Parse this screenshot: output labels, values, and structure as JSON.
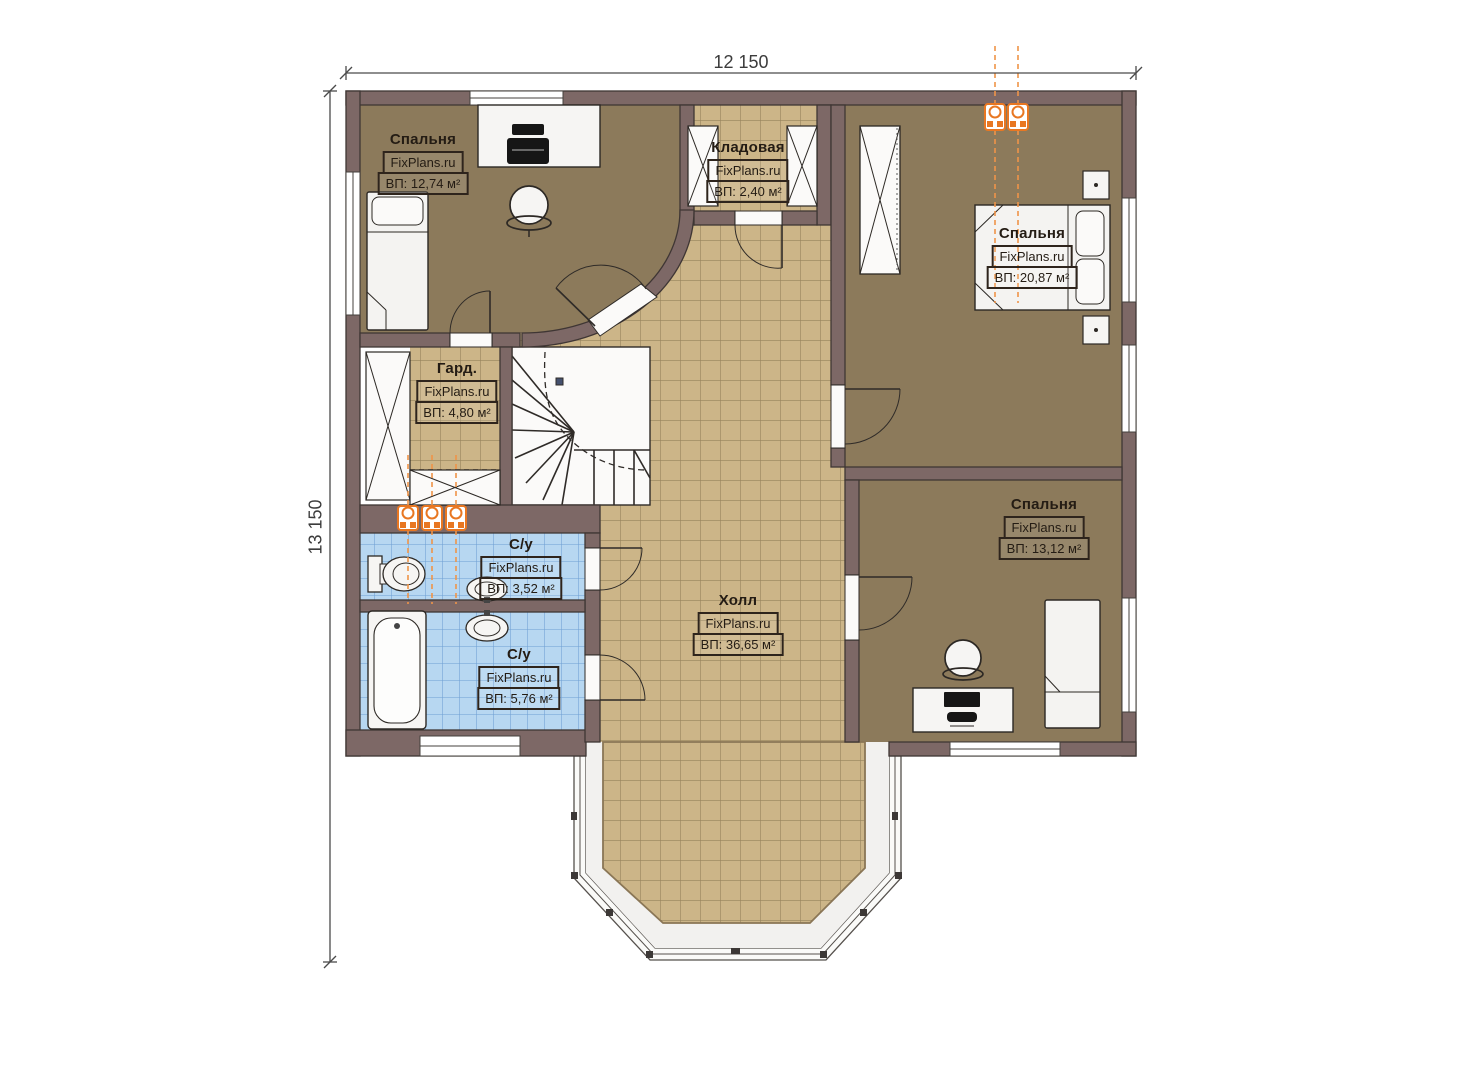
{
  "plan": {
    "type": "floor-plan",
    "watermark": "FixPlans.ru"
  },
  "dimensions": {
    "width_label": "12 150",
    "height_label": "13 150"
  },
  "rooms": [
    {
      "id": "bedroom-top-left",
      "name": "Спальня",
      "site": "FixPlans.ru",
      "area": "ВП: 12,74 м²"
    },
    {
      "id": "storage",
      "name": "Кладовая",
      "site": "FixPlans.ru",
      "area": "ВП: 2,40 м²"
    },
    {
      "id": "bedroom-top-right",
      "name": "Спальня",
      "site": "FixPlans.ru",
      "area": "ВП: 20,87 м²"
    },
    {
      "id": "wardrobe",
      "name": "Гард.",
      "site": "FixPlans.ru",
      "area": "ВП: 4,80 м²"
    },
    {
      "id": "bathroom-upper",
      "name": "С/у",
      "site": "FixPlans.ru",
      "area": "ВП: 3,52 м²"
    },
    {
      "id": "bathroom-lower",
      "name": "С/у",
      "site": "FixPlans.ru",
      "area": "ВП: 5,76 м²"
    },
    {
      "id": "hall",
      "name": "Холл",
      "site": "FixPlans.ru",
      "area": "ВП: 36,65 м²"
    },
    {
      "id": "bedroom-bottom-right",
      "name": "Спальня",
      "site": "FixPlans.ru",
      "area": "ВП: 13,12 м²"
    }
  ],
  "colors": {
    "wall": "#7d6866",
    "wall_outline": "#3f3634",
    "hall_tile": "#ccb588",
    "tile_grout": "#97835c",
    "bedroom_floor": "#8c7a5b",
    "bath_tile": "#b7d7f1",
    "bath_grout": "#6e9fd4",
    "furniture_white": "#f4f3f1",
    "plumbing_orange": "#e87722",
    "dimension_line": "#4a4a4a"
  }
}
